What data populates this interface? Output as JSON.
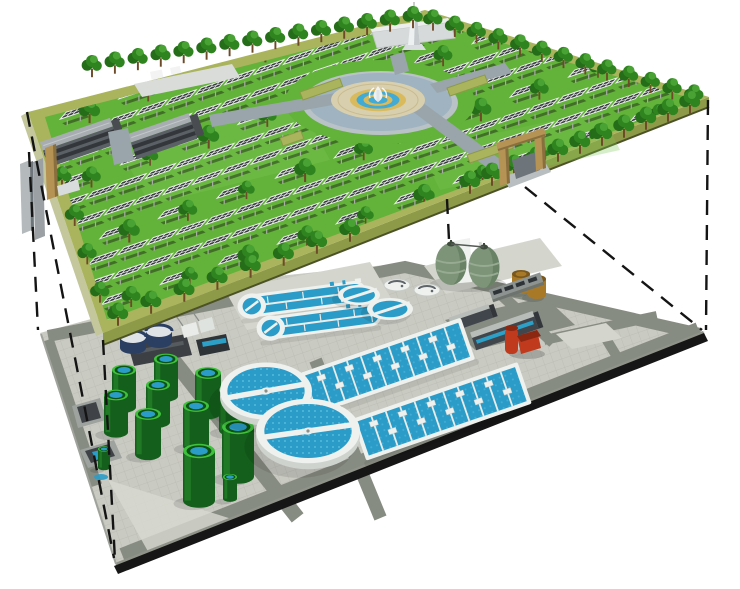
{
  "scene": {
    "type": "3d-cutaway-architectural-illustration",
    "description": "Two-level cutaway rendering: a landscaped solar park at ground level sits on a slab above an underground wastewater treatment plant; dashed projection lines connect the corners of the two slabs. No text appears in the image.",
    "background": "#ffffff"
  },
  "upper_layer": {
    "name": "surface-solar-park",
    "features": [
      {
        "name": "solar-panel-row",
        "count": 13,
        "note": "parallel rows of tilted dark PV panels with white frames on posts"
      },
      {
        "name": "solar-panel",
        "count": 190
      },
      {
        "name": "tree",
        "count": 95,
        "note": "dark green round trees between panel rows and along edges"
      },
      {
        "name": "office-building",
        "count": 2,
        "note": "long gray slab buildings with dark window bands, upper left"
      },
      {
        "name": "central-fountain-plaza",
        "count": 1,
        "rings": [
          "gray ring walk",
          "water moat",
          "beige paving",
          "gold ring",
          "blue ring",
          "gold ring",
          "blue pool",
          "white fountain"
        ]
      },
      {
        "name": "observation-tower",
        "count": 1,
        "note": "white tower with bulb deck, top center"
      },
      {
        "name": "entrance-gate",
        "count": 2,
        "note": "tan portal frames with ramps leading under the park"
      },
      {
        "name": "perimeter-edge-band",
        "count": 1,
        "note": "olive raised edge around the park slab"
      }
    ]
  },
  "lower_layer": {
    "name": "underground-wastewater-treatment-plant",
    "equipment": [
      {
        "name": "circular-clarifier",
        "count": 2,
        "note": "white rim, blue water, rotating white bridge"
      },
      {
        "name": "oxidation-ditch",
        "count": 2,
        "note": "white racetrack basins with blue lanes and round end cap"
      },
      {
        "name": "aeration-basin",
        "count": 2,
        "note": "long blue rectangles with white transverse lanes and pads"
      },
      {
        "name": "secondary-round-tank",
        "count": 2
      },
      {
        "name": "covered-oval-tank",
        "count": 2
      },
      {
        "name": "sludge-storage-tank",
        "count": 12,
        "note": "green cylinders with bright rims and blue tops"
      },
      {
        "name": "egg-shaped-digester",
        "count": 2,
        "note": "sage green eggs on white support frame"
      },
      {
        "name": "fuel-storage-tank",
        "count": 2,
        "note": "brown cylinders"
      },
      {
        "name": "red-utility-building",
        "count": 1
      },
      {
        "name": "service-building",
        "count": 4
      },
      {
        "name": "inlet-structure",
        "count": 2
      },
      {
        "name": "service-road-network",
        "count": 1,
        "note": "dark gray roads over light paving"
      }
    ]
  },
  "connectors": {
    "style": "dashed",
    "color": "#141414",
    "count": 6
  },
  "colors": {
    "background": "#ffffff",
    "line_dark": "#141414",
    "grass": "#63b23a",
    "grass_light": "#7cc653",
    "park_band": "#a9b45c",
    "park_band_side": "#8d9a47",
    "park_band_light": "#c3c79b",
    "park_edge_dark": "#4c5226",
    "tree_dark": "#256d18",
    "tree_mid": "#2f8420",
    "tree_light": "#49a334",
    "trunk": "#6d4a28",
    "panel": "#35393b",
    "panel_frame": "#ebedec",
    "pole": "#a9aca6",
    "bld_roof": "#a7adb1",
    "bld_face": "#5a6065",
    "bld_stripe": "#33373b",
    "back_strip": "#d9dcd9",
    "path_gray": "#9aa5ab",
    "plaza_rim": "#b9c2c6",
    "plaza_water": "#9fb4c0",
    "plaza_pave": "#d8cfae",
    "plaza_gold": "#d9ba5c",
    "plaza_blue": "#41aad5",
    "tower": "#eef1f2",
    "tower_shade": "#c5cbcd",
    "pav": "#c9cac2",
    "pav_line": "#babcb4",
    "road": "#878c82",
    "pad_light": "#d4d6ce",
    "edge_black": "#161616",
    "edge_side": "#8f9288",
    "white_struct": "#eef1ee",
    "white_struct_shade": "#ced3ce",
    "water": "#2b9cc7",
    "water_dot": "#5cbfe2",
    "gtank_body": "#135f1b",
    "gtank_body_light": "#2f9a33",
    "gtank_rim": "#3fc13d",
    "gtank_inner": "#0d5414",
    "navy": "#2b3f63",
    "digester": "#7d9478",
    "digester_dark": "#5a7257",
    "digester_stripe": "#97ab92",
    "brown": "#a87a28",
    "brown_dark": "#7a571c",
    "red": "#c03a1d",
    "red_dark": "#8c2712",
    "dark_bld": "#41464c",
    "dark_bld_roof": "#b9bdb9",
    "blue_window": "#2da0c8",
    "gate_tan": "#b59355",
    "gate_tan_dark": "#8a6f3e",
    "ramp_gray": "#b4babc",
    "ramp_dark": "#6e757a"
  }
}
